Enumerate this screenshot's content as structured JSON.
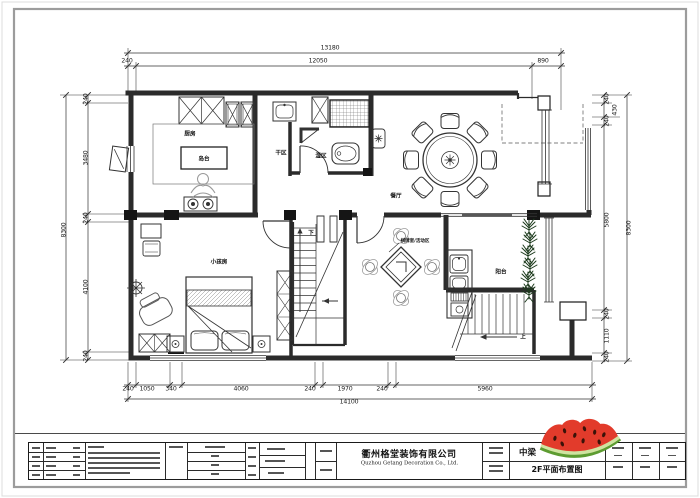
{
  "title_block": {
    "company_cn": "衢州格堂装饰有限公司",
    "company_en": "Quzhou Getang Decoration Co., Ltd.",
    "project_name": "中梁",
    "drawing_title": "2F平面布置图"
  },
  "sticker": {
    "name": "watermelon",
    "flesh": "#e23b2b",
    "rind_dark": "#5d9c31",
    "rind_light": "#cfe3a0",
    "seed": "#3a1208"
  },
  "plan": {
    "rooms": [
      {
        "name": "kitchen",
        "label": "厨房",
        "x": 190,
        "y": 133
      },
      {
        "name": "kitchen-island",
        "label": "岛台",
        "x": 204,
        "y": 158
      },
      {
        "name": "dry-area",
        "label": "干区",
        "x": 281,
        "y": 152
      },
      {
        "name": "wet-area",
        "label": "湿区",
        "x": 321,
        "y": 155
      },
      {
        "name": "dining-room",
        "label": "餐厅",
        "x": 396,
        "y": 195
      },
      {
        "name": "games-activity-area",
        "label": "棋牌室/活动区",
        "x": 415,
        "y": 240,
        "small": true
      },
      {
        "name": "kids-room",
        "label": "小孩房",
        "x": 219,
        "y": 261
      },
      {
        "name": "balcony",
        "label": "阳台",
        "x": 501,
        "y": 271
      },
      {
        "name": "stairs-down",
        "label": "下",
        "x": 311,
        "y": 232
      },
      {
        "name": "stairs-up",
        "label": "上",
        "x": 523,
        "y": 336
      }
    ],
    "dimensions": [
      {
        "t": "13180",
        "x": 330,
        "y": 48
      },
      {
        "t": "240",
        "x": 127,
        "y": 61
      },
      {
        "t": "12050",
        "x": 318,
        "y": 61
      },
      {
        "t": "890",
        "x": 543,
        "y": 61
      },
      {
        "t": "240",
        "x": 86,
        "y": 99,
        "rot": true
      },
      {
        "t": "3480",
        "x": 86,
        "y": 158,
        "rot": true
      },
      {
        "t": "240",
        "x": 86,
        "y": 218,
        "rot": true
      },
      {
        "t": "4100",
        "x": 86,
        "y": 287,
        "rot": true
      },
      {
        "t": "240",
        "x": 86,
        "y": 356,
        "rot": true
      },
      {
        "t": "8300",
        "x": 64,
        "y": 230,
        "rot": true
      },
      {
        "t": "240",
        "x": 607,
        "y": 99,
        "rot": true
      },
      {
        "t": "430",
        "x": 615,
        "y": 110,
        "rot": true
      },
      {
        "t": "240",
        "x": 607,
        "y": 121,
        "rot": true
      },
      {
        "t": "5800",
        "x": 607,
        "y": 220,
        "rot": true
      },
      {
        "t": "240",
        "x": 607,
        "y": 314,
        "rot": true
      },
      {
        "t": "1110",
        "x": 607,
        "y": 336,
        "rot": true
      },
      {
        "t": "240",
        "x": 607,
        "y": 357,
        "rot": true
      },
      {
        "t": "8300",
        "x": 629,
        "y": 228,
        "rot": true
      },
      {
        "t": "240",
        "x": 128,
        "y": 389
      },
      {
        "t": "1050",
        "x": 147,
        "y": 389
      },
      {
        "t": "340",
        "x": 171,
        "y": 389
      },
      {
        "t": "4060",
        "x": 241,
        "y": 389
      },
      {
        "t": "240",
        "x": 310,
        "y": 389
      },
      {
        "t": "1970",
        "x": 345,
        "y": 389
      },
      {
        "t": "240",
        "x": 382,
        "y": 389
      },
      {
        "t": "5960",
        "x": 485,
        "y": 389
      },
      {
        "t": "14100",
        "x": 349,
        "y": 402
      }
    ]
  }
}
